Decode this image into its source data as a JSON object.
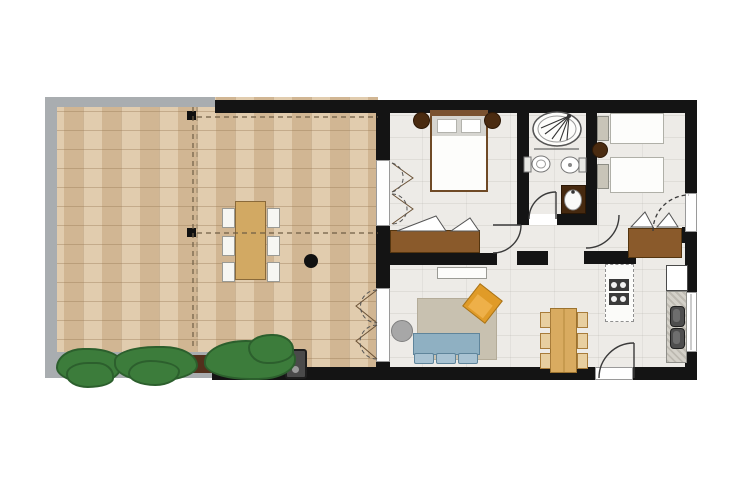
{
  "document": {
    "title": "Apartment floor plan with paved terrace"
  },
  "palette": {
    "wall_black": "#141414",
    "terrace_tile_beige": "#d9c09e",
    "terrace_border_gray": "#a9adb0",
    "interior_floor": "#edebe7",
    "wood_dark_brown": "#8a5a2b",
    "wood_light": "#d9ab60",
    "sofa_blue": "#8fb0c2",
    "armchair_orange": "#e09b28",
    "rug_taupe": "#c8c1b0",
    "bush_green": "#3c7c3b",
    "soil_brown": "#53301c",
    "fixture_white": "#fdfdfb",
    "counter_gray": "#d4d1c9",
    "sink_dark_gray": "#4e4e4e",
    "stool_dark_brown": "#4a2b10"
  },
  "terrace": {
    "items": [
      "paved-tile-floor",
      "gravel-border",
      "outdoor-dining-table",
      "outdoor-chairs-x6",
      "hedge-bushes-x3",
      "soil-patches-x2",
      "barbecue-grill",
      "parasol-base-dot",
      "boundary-posts-x2",
      "boundary-dashed-lines"
    ]
  },
  "rooms": {
    "master_bedroom": {
      "items": [
        "double-bed",
        "headboard",
        "pillows-x2",
        "bedside-stool-left",
        "bedside-stool-right",
        "wardrobe-open-doors",
        "bifold-door-to-terrace",
        "door-to-hall"
      ]
    },
    "bathroom": {
      "items": [
        "oval-shower",
        "spray-symbol",
        "toilet",
        "bidet",
        "washbasin-vanity",
        "door-to-hall"
      ]
    },
    "bedroom_2": {
      "items": [
        "twin-bed-x2",
        "nightstand-x2",
        "round-side-table",
        "wardrobe-open-doors",
        "exterior-door-dashed"
      ]
    },
    "living_room": {
      "items": [
        "three-seat-sofa",
        "round-side-table",
        "angled-armchair",
        "area-rug",
        "sideboard",
        "bifold-door-to-terrace"
      ]
    },
    "kitchen_dining": {
      "items": [
        "dining-table",
        "dining-chairs-x6",
        "cooktop-counter",
        "double-sink-counter",
        "tall-cabinet",
        "window-right-wall",
        "entrance-door"
      ]
    }
  }
}
